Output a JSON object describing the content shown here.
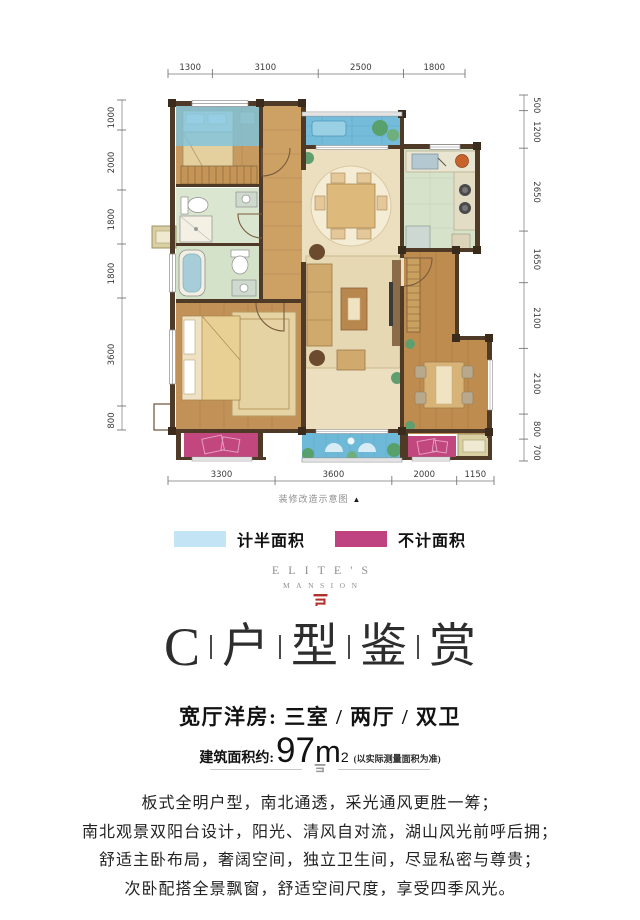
{
  "floorplan": {
    "note": "装修改造示意图",
    "note_arrow": "▲",
    "dims_top": [
      "1300",
      "3100",
      "2500",
      "1800"
    ],
    "dims_bottom": [
      "3300",
      "3600",
      "2000",
      "1150"
    ],
    "dims_left": [
      "1000",
      "2000",
      "1800",
      "1800",
      "3600",
      "800"
    ],
    "dims_right": [
      "500",
      "1200",
      "2650",
      "1650",
      "2100",
      "2100",
      "800",
      "700"
    ],
    "colors": {
      "wall": "#4e3a27",
      "balcony_blue": "#6fb9d8",
      "bay_magenta": "#c2477f",
      "wood": "#c79a60",
      "marble": "#ecdfbf",
      "tile": "#d6e3ca"
    }
  },
  "legend": {
    "items": [
      {
        "label": "计半面积",
        "color": "#c2e4f4"
      },
      {
        "label": "不计面积",
        "color": "#bf4380"
      }
    ]
  },
  "brand": {
    "line1": "ELITE'S",
    "line2": "MANSION",
    "mark_color": "#b0312a"
  },
  "title": {
    "chars": [
      "C",
      "户",
      "型",
      "鉴",
      "赏"
    ]
  },
  "subtitle": {
    "text": "宽厅洋房: 三室 / 两厅 / 双卫"
  },
  "area": {
    "prefix": "建筑面积约:",
    "value": "97",
    "unit": "m",
    "sup": "2",
    "note": "(以实际测量面积为准)"
  },
  "description": {
    "lines": [
      "板式全明户型，南北通透，采光通风更胜一筹；",
      "南北观景双阳台设计，阳光、清风自对流，湖山风光前呼后拥；",
      "舒适主卧布局，奢阔空间，独立卫生间，尽显私密与尊贵；",
      "次卧配搭全景飘窗，舒适空间尺度，享受四季风光。"
    ]
  }
}
